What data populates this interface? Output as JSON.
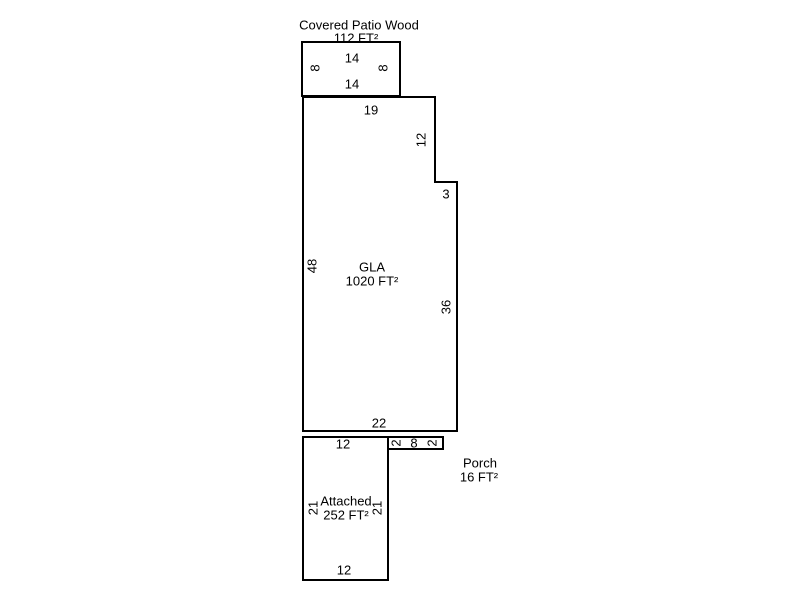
{
  "plan": {
    "type": "floorplan-sketch",
    "colors": {
      "line": "#000000",
      "background": "#ffffff",
      "text": "#000000"
    },
    "patio": {
      "title": "Covered Patio Wood",
      "area": "112 FT²",
      "dim_top": "14",
      "dim_left": "8",
      "dim_right": "8",
      "dim_bottom": "14"
    },
    "gla": {
      "title": "GLA",
      "area": "1020 FT²",
      "dim_top": "19",
      "dim_right_upper": "12",
      "dim_step": "3",
      "dim_left": "48",
      "dim_right_lower": "36",
      "dim_bottom": "22"
    },
    "porch": {
      "title": "Porch",
      "area": "16 FT²",
      "dim_left": "2",
      "dim_width": "8",
      "dim_right": "2"
    },
    "garage": {
      "title": "Attached",
      "area": "252 FT²",
      "dim_top": "12",
      "dim_left": "21",
      "dim_right": "21",
      "dim_bottom": "12"
    }
  }
}
